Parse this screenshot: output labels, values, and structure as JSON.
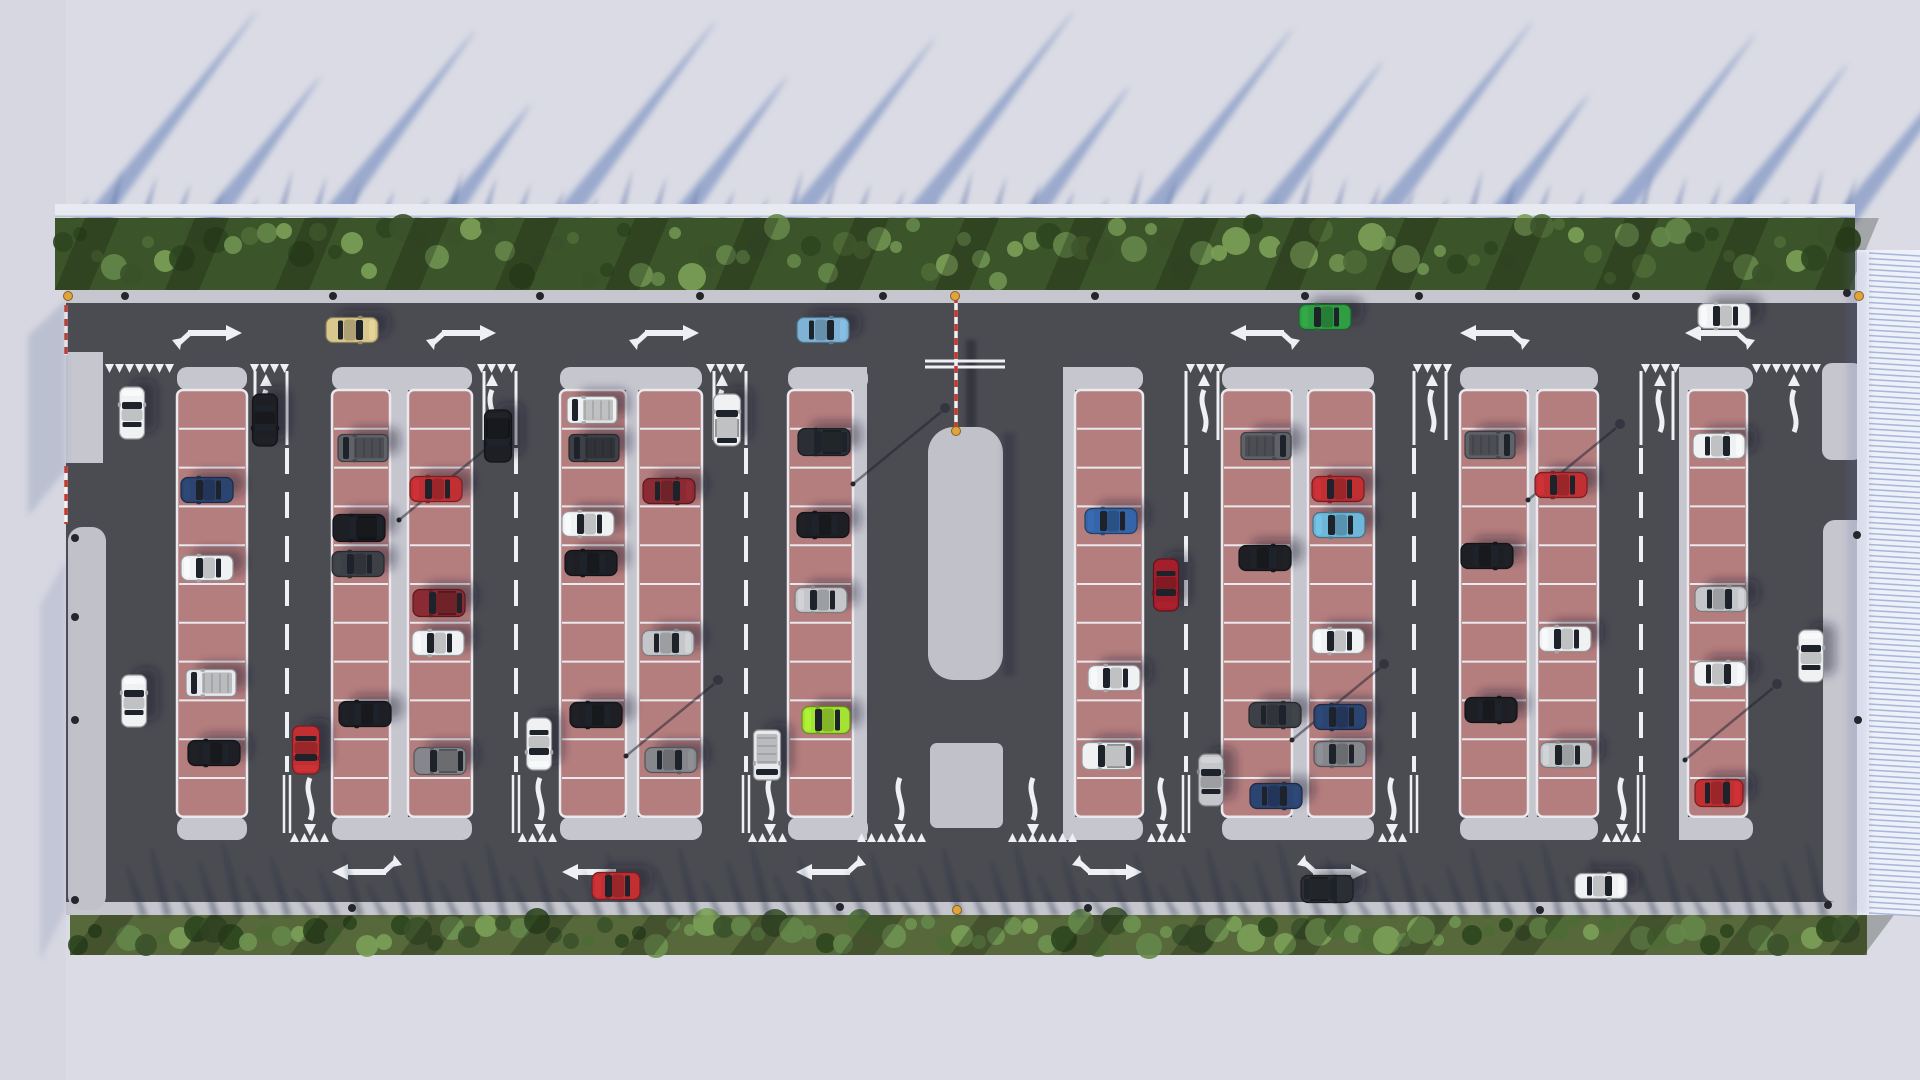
{
  "scene": {
    "width": 1920,
    "height": 1080,
    "title": "aerial-parking-lot-render"
  },
  "palette": {
    "street": "#dadbe4",
    "street_left": "#d6d7e1",
    "fence": "#e8eaf1",
    "fence_edge": "#bcc2d4",
    "streak": "rgba(108,132,188,0.58)",
    "spike_top": "rgba(96,116,170,0.48)",
    "spike_bottom": "rgba(34,40,58,0.36)",
    "hedge_top": "#3c5429",
    "hedge_bottom": "#57693a",
    "foliage": [
      "#4e6c36",
      "#65874a",
      "#3a512a",
      "#6f9352",
      "#2e461f",
      "#7ba058"
    ],
    "sidewalk": "#c6c6cf",
    "island": "#c1c1ca",
    "asphalt": "#4b4b52",
    "asphalt_dark": "#434349",
    "marking": "#eef0f4",
    "stall": "#b57e7e",
    "stall_line": "#e9e9ee",
    "red_dash": "#c23b30",
    "bollard": "#24262c",
    "amber": "#dfa43c",
    "structure_face": "#eef1f9",
    "structure_rib": "#a9b7d8",
    "structure_edge": "#f6f7fb",
    "car_shadow": "rgba(24,28,42,0.42)",
    "glass": "#1e222a",
    "car_colors": {
      "white": "#f0f1f3",
      "whitevan": "#e9eaed",
      "silver": "#c4c6ca",
      "gray": "#85878c",
      "dark": "#3d4046",
      "black": "#1d1f24",
      "darksuv": "#2b2e34",
      "grayvan": "#5f6268",
      "navy": "#2c4470",
      "blue": "#3565a8",
      "steel": "#7fb3d6",
      "cyan": "#6fb7d9",
      "red": "#c22f33",
      "crimson": "#a31f2c",
      "darkred": "#8c2a33",
      "lime": "#a4e233",
      "green": "#2f9e43",
      "beige": "#d9c88e"
    }
  },
  "layout": {
    "lot": {
      "x": 66,
      "y": 290,
      "w": 1791,
      "h": 625
    },
    "asphalt": {
      "x": 66,
      "y": 303,
      "w": 1791,
      "h": 599
    },
    "top_sidewalk": {
      "x": 66,
      "y": 290,
      "w": 1791,
      "h": 13
    },
    "bottom_sidewalk": {
      "x": 93,
      "y": 902,
      "w": 1774,
      "h": 13
    },
    "hedge_top": {
      "x": 55,
      "y": 218,
      "w": 1800,
      "h": 72
    },
    "hedge_bottom": {
      "x": 70,
      "y": 915,
      "w": 1797,
      "h": 40
    },
    "fence": {
      "x": 55,
      "y": 204,
      "w": 1800,
      "h": 13
    },
    "left_sidewalk": {
      "x": 66,
      "y": 352,
      "w": 37,
      "h": 111
    },
    "left_island": {
      "x": 68,
      "y": 527,
      "w": 38,
      "h": 383,
      "r": 14
    },
    "right_bulb": {
      "x": 1822,
      "y": 363,
      "w": 41,
      "h": 97,
      "r": 10
    },
    "right_sidewalk": {
      "x": 1823,
      "y": 520,
      "w": 44,
      "h": 382,
      "r": 12
    },
    "structure": {
      "x": 1869,
      "y": 250,
      "w": 51,
      "h": 665
    },
    "structure_edge": {
      "x": 1857,
      "y": 250,
      "w": 12,
      "h": 665
    },
    "island": {
      "x": 928,
      "y": 427,
      "w": 75,
      "h": 253,
      "r": 26
    },
    "island2": {
      "x": 930,
      "y": 743,
      "w": 73,
      "h": 85,
      "r": 7
    },
    "island_slot": {
      "x": 958,
      "y": 335,
      "w": 13,
      "h": 92
    },
    "stop_bars": {
      "x1": 925,
      "x2": 1005,
      "y": [
        361,
        367
      ]
    },
    "red_dashes": [
      {
        "x1": 66,
        "y1": 305,
        "x2": 66,
        "y2": 355
      },
      {
        "x1": 66,
        "y1": 466,
        "x2": 66,
        "y2": 524
      },
      {
        "x1": 956,
        "y1": 296,
        "x2": 956,
        "y2": 428
      },
      {
        "x1": 1860,
        "y1": 306,
        "x2": 1860,
        "y2": 357
      }
    ],
    "stall_rows": {
      "y0": 390,
      "h": 38.8,
      "n": 11
    },
    "walkways": [
      [
        390,
        18
      ],
      [
        626,
        12
      ],
      [
        853,
        14
      ],
      [
        1063,
        12
      ],
      [
        1292,
        16
      ],
      [
        1528,
        9
      ],
      [
        1679,
        9
      ]
    ],
    "caps": [
      [
        177,
        70
      ],
      [
        332,
        140
      ],
      [
        560,
        142
      ],
      [
        788,
        80
      ],
      [
        1063,
        80
      ],
      [
        1222,
        152
      ],
      [
        1460,
        138
      ],
      [
        1679,
        74
      ]
    ],
    "columns": [
      [
        177,
        70
      ],
      [
        332,
        58
      ],
      [
        408,
        64
      ],
      [
        560,
        66
      ],
      [
        638,
        64
      ],
      [
        788,
        65
      ],
      [
        1075,
        68
      ],
      [
        1222,
        70
      ],
      [
        1308,
        66
      ],
      [
        1460,
        68
      ],
      [
        1537,
        61
      ],
      [
        1688,
        59
      ]
    ]
  },
  "markings": {
    "aisle_dash_x": [
      287,
      516,
      746,
      1186,
      1414,
      1641
    ],
    "dash_y": [
      448,
      772
    ],
    "top_lines": [
      [
        287,
        -1
      ],
      [
        516,
        -1
      ],
      [
        746,
        -1
      ],
      [
        1186,
        1
      ],
      [
        1414,
        1
      ],
      [
        1641,
        1
      ]
    ],
    "chevrons_top": [
      [
        105,
        180
      ],
      [
        250,
        290
      ],
      [
        477,
        517
      ],
      [
        706,
        746
      ],
      [
        1186,
        1224
      ],
      [
        1413,
        1457
      ],
      [
        1641,
        1681
      ],
      [
        1752,
        1822
      ]
    ],
    "chevrons_bottom": [
      [
        290,
        330
      ],
      [
        518,
        558
      ],
      [
        748,
        788
      ],
      [
        857,
        927
      ],
      [
        1008,
        1077
      ],
      [
        1147,
        1185
      ],
      [
        1378,
        1414
      ],
      [
        1602,
        1640
      ]
    ],
    "s_arrows_up": [
      266,
      492,
      722,
      1204,
      1432,
      1660,
      1794
    ],
    "s_arrows_down": [
      310,
      540,
      770,
      900,
      1033,
      1162,
      1392,
      1622
    ],
    "combo_top": [
      {
        "x": 210,
        "d": 1
      },
      {
        "x": 464,
        "d": 1
      },
      {
        "x": 667,
        "d": 1
      },
      {
        "x": 1262,
        "d": -1
      },
      {
        "x": 1492,
        "d": -1
      },
      {
        "x": 1717,
        "d": -1
      }
    ],
    "combo_top_y": 333,
    "combo_bottom": [
      {
        "x": 364,
        "d": -1
      },
      {
        "x": 594,
        "d": -1,
        "plain": true
      },
      {
        "x": 828,
        "d": -1
      },
      {
        "x": 1110,
        "d": 1
      },
      {
        "x": 1335,
        "d": 1
      }
    ],
    "combo_bottom_y": 872
  },
  "dots": {
    "bollards": [
      [
        125,
        296
      ],
      [
        333,
        296
      ],
      [
        540,
        296
      ],
      [
        700,
        296
      ],
      [
        883,
        296
      ],
      [
        1095,
        296
      ],
      [
        1305,
        296
      ],
      [
        1419,
        296
      ],
      [
        1636,
        296
      ],
      [
        1847,
        293
      ],
      [
        352,
        908
      ],
      [
        840,
        907
      ],
      [
        1088,
        908
      ],
      [
        1540,
        910
      ],
      [
        75,
        538
      ],
      [
        75,
        617
      ],
      [
        75,
        720
      ],
      [
        75,
        900
      ],
      [
        1857,
        535
      ],
      [
        1858,
        720
      ],
      [
        1828,
        905
      ]
    ],
    "amber": [
      [
        68,
        296
      ],
      [
        955,
        296
      ],
      [
        956,
        431
      ],
      [
        957,
        910
      ],
      [
        1859,
        296
      ]
    ]
  },
  "lamps": [
    [
      399,
      520
    ],
    [
      626,
      756
    ],
    [
      853,
      484
    ],
    [
      1292,
      740
    ],
    [
      1528,
      500
    ],
    [
      1685,
      760
    ]
  ],
  "streaks": {
    "base_y": 225,
    "items": [
      [
        78,
        215
      ],
      [
        195,
        150
      ],
      [
        312,
        196
      ],
      [
        428,
        122
      ],
      [
        545,
        205
      ],
      [
        662,
        150
      ],
      [
        778,
        188
      ],
      [
        895,
        215
      ],
      [
        1012,
        140
      ],
      [
        1128,
        198
      ],
      [
        1245,
        165
      ],
      [
        1362,
        205
      ],
      [
        1478,
        132
      ],
      [
        1595,
        192
      ],
      [
        1712,
        162
      ],
      [
        1828,
        205
      ]
    ]
  },
  "spikes_top": {
    "x0": 70,
    "x1": 1840,
    "step": 34,
    "base_y": 222,
    "len": 42,
    "lean": 16
  },
  "spikes_bottom": {
    "x0": 140,
    "x1": 1825,
    "step": 24,
    "base_y": 916,
    "len": 58,
    "lean": -14
  },
  "cars": [
    {
      "x": 352,
      "y": 330,
      "dir": "E",
      "type": "sedan",
      "color": "beige"
    },
    {
      "x": 823,
      "y": 330,
      "dir": "E",
      "type": "sedan",
      "color": "steel"
    },
    {
      "x": 1325,
      "y": 317,
      "dir": "W",
      "type": "sedan",
      "color": "green"
    },
    {
      "x": 1724,
      "y": 316,
      "dir": "W",
      "type": "sedan",
      "color": "white"
    },
    {
      "x": 616,
      "y": 886,
      "dir": "W",
      "type": "sport",
      "color": "red"
    },
    {
      "x": 1327,
      "y": 889,
      "dir": "E",
      "type": "suv",
      "color": "darksuv"
    },
    {
      "x": 1601,
      "y": 886,
      "dir": "E",
      "type": "sedan",
      "color": "white"
    },
    {
      "x": 132,
      "y": 413,
      "dir": "N",
      "type": "sedan",
      "color": "white"
    },
    {
      "x": 134,
      "y": 701,
      "dir": "N",
      "type": "sedan",
      "color": "white"
    },
    {
      "x": 265,
      "y": 420,
      "dir": "S",
      "type": "sedan",
      "color": "black"
    },
    {
      "x": 306,
      "y": 750,
      "dir": "S",
      "type": "sport",
      "color": "red"
    },
    {
      "x": 498,
      "y": 436,
      "dir": "S",
      "type": "suv",
      "color": "black"
    },
    {
      "x": 539,
      "y": 744,
      "dir": "S",
      "type": "sedan",
      "color": "white"
    },
    {
      "x": 727,
      "y": 420,
      "dir": "N",
      "type": "suv",
      "color": "white"
    },
    {
      "x": 767,
      "y": 755,
      "dir": "S",
      "type": "van",
      "color": "whitevan"
    },
    {
      "x": 1166,
      "y": 585,
      "dir": "S",
      "type": "sedan",
      "color": "crimson"
    },
    {
      "x": 1211,
      "y": 780,
      "dir": "N",
      "type": "sedan",
      "color": "silver"
    },
    {
      "x": 1811,
      "y": 656,
      "dir": "N",
      "type": "sedan",
      "color": "white"
    },
    {
      "x": 207,
      "y": 490,
      "dir": "W",
      "type": "sedan",
      "color": "navy"
    },
    {
      "x": 207,
      "y": 568,
      "dir": "W",
      "type": "sedan",
      "color": "white"
    },
    {
      "x": 211,
      "y": 683,
      "dir": "W",
      "type": "van",
      "color": "whitevan"
    },
    {
      "x": 214,
      "y": 753,
      "dir": "W",
      "type": "sedan",
      "color": "black"
    },
    {
      "x": 363,
      "y": 448,
      "dir": "W",
      "type": "van",
      "color": "grayvan"
    },
    {
      "x": 359,
      "y": 528,
      "dir": "W",
      "type": "suv",
      "color": "black"
    },
    {
      "x": 358,
      "y": 564,
      "dir": "W",
      "type": "sedan",
      "color": "dark"
    },
    {
      "x": 365,
      "y": 714,
      "dir": "W",
      "type": "sedan",
      "color": "black"
    },
    {
      "x": 436,
      "y": 489,
      "dir": "W",
      "type": "sedan",
      "color": "red"
    },
    {
      "x": 439,
      "y": 603,
      "dir": "W",
      "type": "suv",
      "color": "darkred"
    },
    {
      "x": 438,
      "y": 643,
      "dir": "W",
      "type": "sedan",
      "color": "white"
    },
    {
      "x": 440,
      "y": 761,
      "dir": "W",
      "type": "suv",
      "color": "gray"
    },
    {
      "x": 592,
      "y": 410,
      "dir": "W",
      "type": "van",
      "color": "white"
    },
    {
      "x": 594,
      "y": 448,
      "dir": "W",
      "type": "van",
      "color": "dark"
    },
    {
      "x": 588,
      "y": 524,
      "dir": "W",
      "type": "sedan",
      "color": "white"
    },
    {
      "x": 591,
      "y": 563,
      "dir": "W",
      "type": "sedan",
      "color": "black"
    },
    {
      "x": 596,
      "y": 715,
      "dir": "W",
      "type": "sedan",
      "color": "black"
    },
    {
      "x": 669,
      "y": 491,
      "dir": "E",
      "type": "sedan",
      "color": "darkred"
    },
    {
      "x": 668,
      "y": 643,
      "dir": "E",
      "type": "sedan",
      "color": "silver"
    },
    {
      "x": 671,
      "y": 760,
      "dir": "E",
      "type": "sedan",
      "color": "gray"
    },
    {
      "x": 824,
      "y": 442,
      "dir": "W",
      "type": "suv",
      "color": "darksuv"
    },
    {
      "x": 823,
      "y": 525,
      "dir": "W",
      "type": "sedan",
      "color": "black"
    },
    {
      "x": 821,
      "y": 600,
      "dir": "W",
      "type": "sedan",
      "color": "silver"
    },
    {
      "x": 826,
      "y": 720,
      "dir": "W",
      "type": "sport",
      "color": "lime"
    },
    {
      "x": 1111,
      "y": 521,
      "dir": "W",
      "type": "sedan",
      "color": "blue"
    },
    {
      "x": 1114,
      "y": 678,
      "dir": "W",
      "type": "sedan",
      "color": "white"
    },
    {
      "x": 1108,
      "y": 756,
      "dir": "W",
      "type": "suv",
      "color": "white"
    },
    {
      "x": 1266,
      "y": 446,
      "dir": "E",
      "type": "van",
      "color": "grayvan"
    },
    {
      "x": 1265,
      "y": 558,
      "dir": "E",
      "type": "sedan",
      "color": "black"
    },
    {
      "x": 1275,
      "y": 715,
      "dir": "E",
      "type": "sedan",
      "color": "dark"
    },
    {
      "x": 1276,
      "y": 796,
      "dir": "E",
      "type": "sedan",
      "color": "navy"
    },
    {
      "x": 1338,
      "y": 489,
      "dir": "W",
      "type": "sedan",
      "color": "red"
    },
    {
      "x": 1339,
      "y": 525,
      "dir": "W",
      "type": "sedan",
      "color": "cyan"
    },
    {
      "x": 1338,
      "y": 641,
      "dir": "W",
      "type": "sedan",
      "color": "white"
    },
    {
      "x": 1340,
      "y": 717,
      "dir": "W",
      "type": "sedan",
      "color": "navy"
    },
    {
      "x": 1340,
      "y": 754,
      "dir": "W",
      "type": "sedan",
      "color": "gray"
    },
    {
      "x": 1490,
      "y": 445,
      "dir": "E",
      "type": "van",
      "color": "grayvan"
    },
    {
      "x": 1487,
      "y": 556,
      "dir": "E",
      "type": "sedan",
      "color": "black"
    },
    {
      "x": 1491,
      "y": 710,
      "dir": "E",
      "type": "sedan",
      "color": "black"
    },
    {
      "x": 1561,
      "y": 485,
      "dir": "W",
      "type": "sedan",
      "color": "red"
    },
    {
      "x": 1565,
      "y": 639,
      "dir": "W",
      "type": "sedan",
      "color": "white"
    },
    {
      "x": 1566,
      "y": 755,
      "dir": "W",
      "type": "sedan",
      "color": "silver"
    },
    {
      "x": 1719,
      "y": 446,
      "dir": "E",
      "type": "sedan",
      "color": "white"
    },
    {
      "x": 1721,
      "y": 599,
      "dir": "E",
      "type": "sedan",
      "color": "silver"
    },
    {
      "x": 1720,
      "y": 674,
      "dir": "E",
      "type": "sedan",
      "color": "white"
    },
    {
      "x": 1719,
      "y": 793,
      "dir": "E",
      "type": "sport",
      "color": "red"
    }
  ]
}
